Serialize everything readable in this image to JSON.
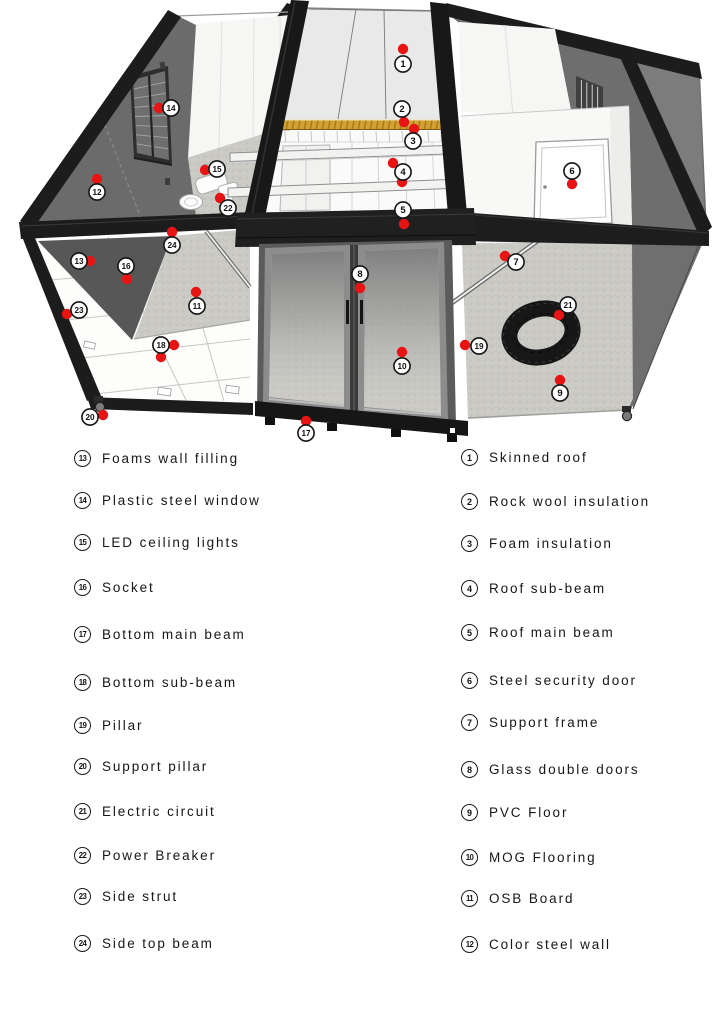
{
  "colors": {
    "marker_red": "#e81414",
    "frame_black": "#1c1c1c",
    "insulation_yellow": "#d2a033"
  },
  "legend": {
    "left_column": [
      {
        "number": "13",
        "label": "Foams wall filling"
      },
      {
        "number": "14",
        "label": "Plastic steel window"
      },
      {
        "number": "15",
        "label": "LED ceiling lights"
      },
      {
        "number": "16",
        "label": "Socket"
      },
      {
        "number": "17",
        "label": "Bottom main beam"
      },
      {
        "number": "18",
        "label": "Bottom sub-beam"
      },
      {
        "number": "19",
        "label": "Pillar"
      },
      {
        "number": "20",
        "label": "Support pillar"
      },
      {
        "number": "21",
        "label": "Electric circuit"
      },
      {
        "number": "22",
        "label": "Power Breaker"
      },
      {
        "number": "23",
        "label": "Side strut"
      },
      {
        "number": "24",
        "label": "Side top beam"
      }
    ],
    "right_column": [
      {
        "number": "1",
        "label": "Skinned roof"
      },
      {
        "number": "2",
        "label": "Rock wool insulation"
      },
      {
        "number": "3",
        "label": "Foam insulation"
      },
      {
        "number": "4",
        "label": "Roof sub-beam"
      },
      {
        "number": "5",
        "label": "Roof main beam"
      },
      {
        "number": "6",
        "label": "Steel security door"
      },
      {
        "number": "7",
        "label": "Support frame"
      },
      {
        "number": "8",
        "label": "Glass double doors"
      },
      {
        "number": "9",
        "label": "PVC Floor"
      },
      {
        "number": "10",
        "label": "MOG Flooring"
      },
      {
        "number": "11",
        "label": "OSB Board"
      },
      {
        "number": "12",
        "label": "Color steel wall"
      }
    ]
  },
  "diagram": {
    "markers": [
      {
        "number": "1",
        "circle": [
          403,
          64
        ],
        "dots": [
          [
            403,
            49
          ]
        ]
      },
      {
        "number": "2",
        "circle": [
          402,
          109
        ],
        "dots": [
          [
            404,
            122
          ]
        ]
      },
      {
        "number": "3",
        "circle": [
          413,
          141
        ],
        "dots": [
          [
            414,
            129
          ]
        ]
      },
      {
        "number": "4",
        "circle": [
          403,
          172
        ],
        "dots": [
          [
            393,
            163
          ],
          [
            402,
            182
          ]
        ]
      },
      {
        "number": "5",
        "circle": [
          403,
          210
        ],
        "dots": [
          [
            404,
            224
          ]
        ]
      },
      {
        "number": "6",
        "circle": [
          572,
          171
        ],
        "dots": [
          [
            572,
            184
          ]
        ]
      },
      {
        "number": "7",
        "circle": [
          516,
          262
        ],
        "dots": [
          [
            505,
            256
          ]
        ]
      },
      {
        "number": "8",
        "circle": [
          360,
          274
        ],
        "dots": [
          [
            360,
            288
          ]
        ]
      },
      {
        "number": "9",
        "circle": [
          560,
          393
        ],
        "dots": [
          [
            560,
            380
          ]
        ]
      },
      {
        "number": "10",
        "circle": [
          402,
          366
        ],
        "dots": [
          [
            402,
            352
          ]
        ]
      },
      {
        "number": "11",
        "circle": [
          197,
          306
        ],
        "dots": [
          [
            196,
            292
          ]
        ]
      },
      {
        "number": "12",
        "circle": [
          97,
          192
        ],
        "dots": [
          [
            97,
            179
          ]
        ]
      },
      {
        "number": "13",
        "circle": [
          79,
          261
        ],
        "dots": [
          [
            90,
            261
          ]
        ]
      },
      {
        "number": "14",
        "circle": [
          171,
          108
        ],
        "dots": [
          [
            159,
            108
          ]
        ]
      },
      {
        "number": "15",
        "circle": [
          217,
          169
        ],
        "dots": [
          [
            205,
            170
          ]
        ]
      },
      {
        "number": "16",
        "circle": [
          126,
          266
        ],
        "dots": [
          [
            127,
            279
          ]
        ]
      },
      {
        "number": "17",
        "circle": [
          306,
          433
        ],
        "dots": [
          [
            306,
            421
          ]
        ]
      },
      {
        "number": "18",
        "circle": [
          161,
          345
        ],
        "dots": [
          [
            174,
            345
          ],
          [
            161,
            357
          ]
        ]
      },
      {
        "number": "19",
        "circle": [
          479,
          346
        ],
        "dots": [
          [
            465,
            345
          ]
        ]
      },
      {
        "number": "20",
        "circle": [
          90,
          417
        ],
        "dots": [
          [
            103,
            415
          ]
        ]
      },
      {
        "number": "21",
        "circle": [
          568,
          305
        ],
        "dots": [
          [
            559,
            315
          ]
        ]
      },
      {
        "number": "22",
        "circle": [
          228,
          208
        ],
        "dots": [
          [
            220,
            198
          ]
        ]
      },
      {
        "number": "23",
        "circle": [
          79,
          310
        ],
        "dots": [
          [
            67,
            314
          ]
        ]
      },
      {
        "number": "24",
        "circle": [
          172,
          245
        ],
        "dots": [
          [
            172,
            232
          ]
        ]
      }
    ]
  }
}
